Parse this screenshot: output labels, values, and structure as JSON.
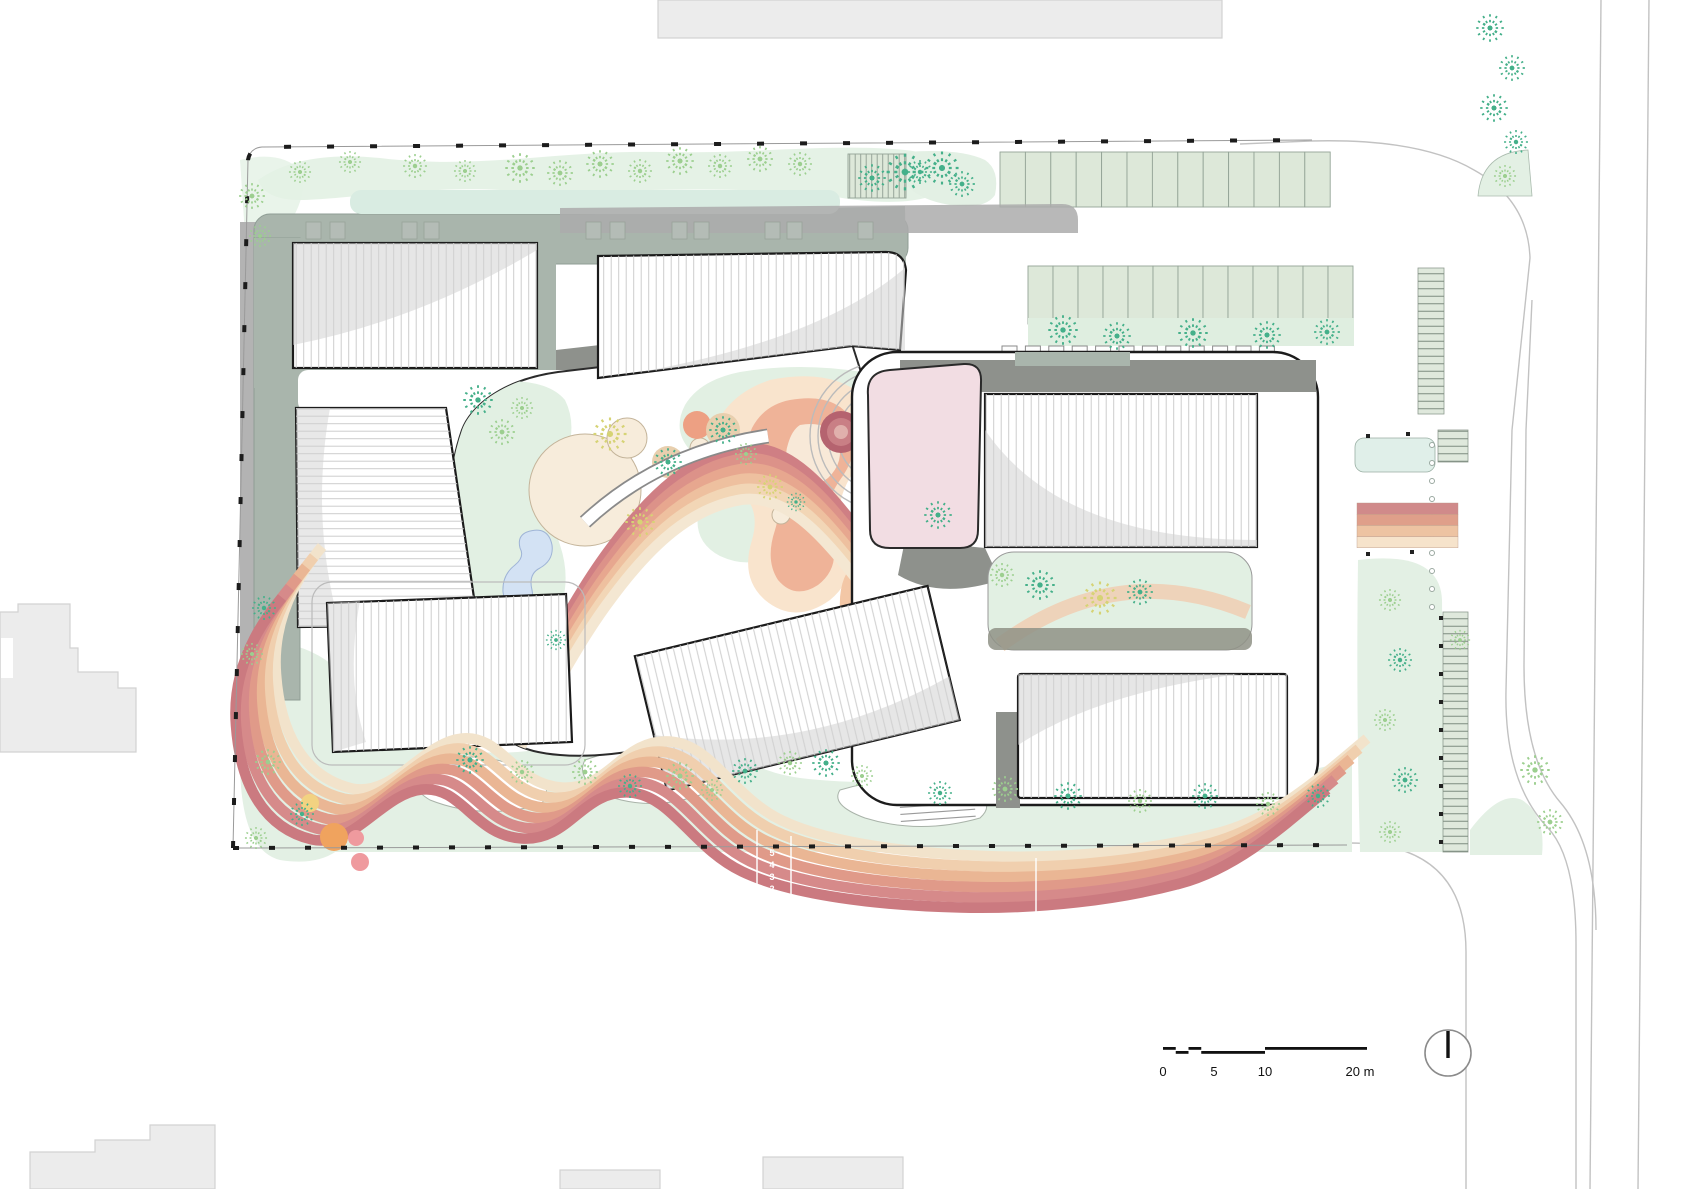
{
  "plan": {
    "type": "architectural-site-plan",
    "description": "Campus roof plan with ribbed building roofs, sage podium, playground, rainbow running track, parking and landscape"
  },
  "scale_bar": {
    "tick_0": "0",
    "tick_5": "5",
    "tick_10": "10",
    "tick_20": "20 m"
  },
  "track": {
    "lane_5": "5",
    "lane_4": "4",
    "lane_3": "3",
    "lane_2": "2",
    "lane_1": "1"
  },
  "icons": {
    "north_indicator": "north-arrow-icon"
  },
  "palette": {
    "track_stripes_top_to_bottom": [
      "#f2e3cb",
      "#f0cfae",
      "#eab694",
      "#e09a89",
      "#d68a8a",
      "#cb7a80"
    ],
    "landscape_green": "#e3f0e4",
    "parking_green": "#dde8d9",
    "tree_teal": "#45b08a",
    "tree_light_green": "#9ccf8f",
    "tree_yellow": "#d6d375",
    "podium_sage": "#a9b5ac",
    "deck_gray": "#8e918c",
    "pink_roof": "#f2dde3",
    "pond_blue": "#d3e2f4",
    "cream_mound": "#f7ecdb",
    "roof_white": "#ffffff",
    "outline_black": "#1b1b1b"
  }
}
